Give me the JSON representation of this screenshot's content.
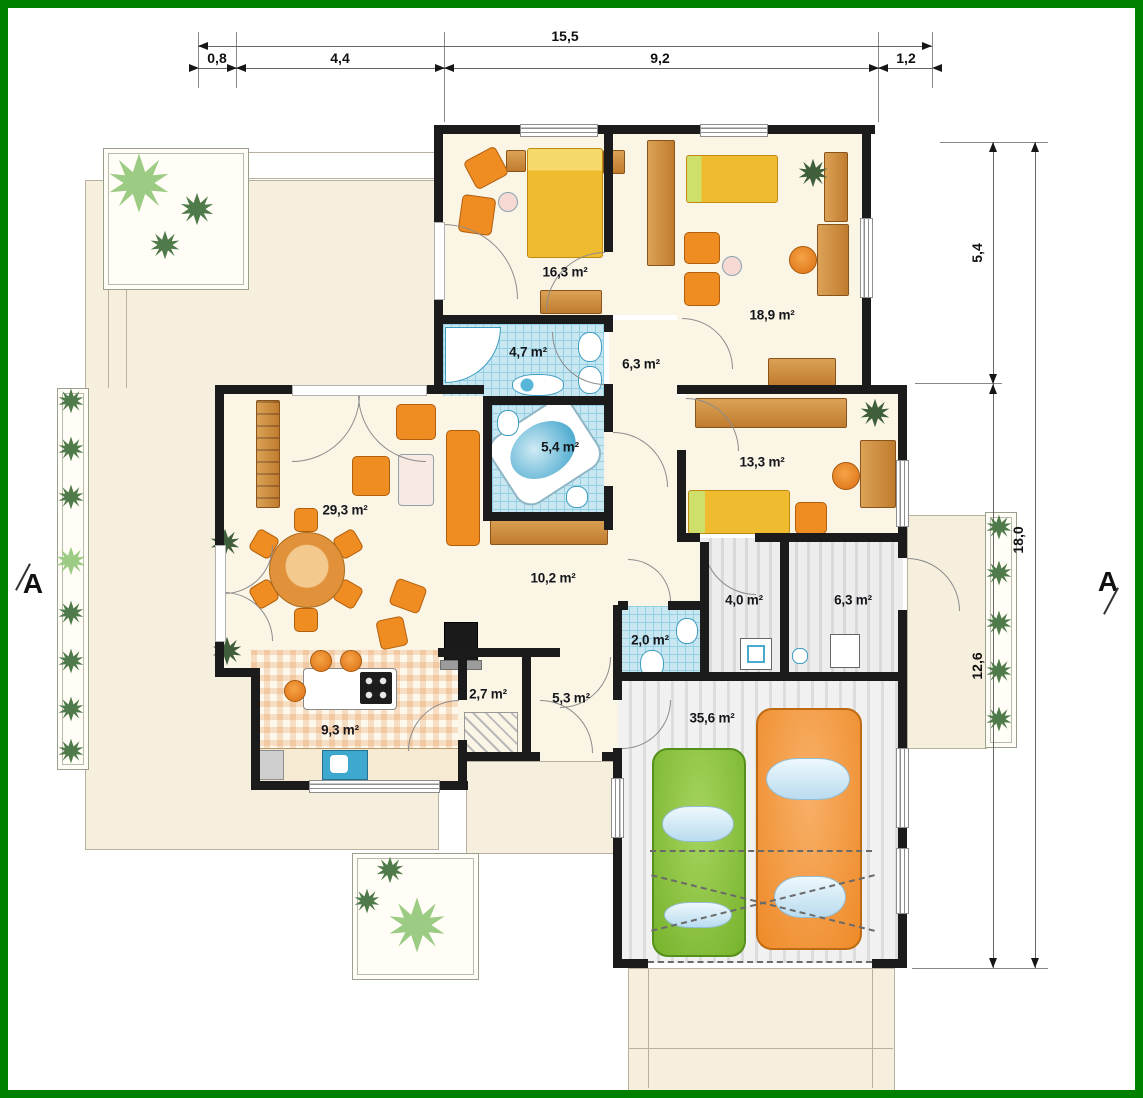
{
  "frame": {
    "color": "#008000"
  },
  "dimensions": {
    "top": {
      "total": "15,5",
      "segments": [
        "0,8",
        "4,4",
        "9,2",
        "1,2"
      ]
    },
    "right": {
      "total": "18,0",
      "segments": [
        "5,4",
        "12,6"
      ]
    }
  },
  "section_markers": {
    "left": "A",
    "right": "A"
  },
  "rooms": {
    "bedroom_1": {
      "area": "16,3 m²"
    },
    "bedroom_2": {
      "area": "18,9 m²"
    },
    "bathroom_1": {
      "area": "4,7 m²"
    },
    "hall_upper": {
      "area": "6,3 m²"
    },
    "bathroom_2": {
      "area": "5,4 m²"
    },
    "bedroom_3": {
      "area": "13,3 m²"
    },
    "living_room": {
      "area": "29,3 m²"
    },
    "hall_main": {
      "area": "10,2 m²"
    },
    "utility_laundry": {
      "area": "4,0 m²"
    },
    "utility_boiler": {
      "area": "6,3 m²"
    },
    "wc": {
      "area": "2,0 m²"
    },
    "pantry": {
      "area": "2,7 m²"
    },
    "hall_entry": {
      "area": "5,3 m²"
    },
    "kitchen": {
      "area": "9,3 m²"
    },
    "garage": {
      "area": "35,6 m²"
    }
  },
  "colors": {
    "frame_green": "#008000",
    "wall": "#1b1b1b",
    "terrace": "#f6efdd",
    "room_floor": "#fbf5e6",
    "bathroom_floor": "#c9e7f1",
    "garage_floor": "#e5e5e5",
    "bed_yellow": "#f0bc2f",
    "furniture_orange": "#ef8c22",
    "wood": "#c98440",
    "car_green": "#8dc63f",
    "car_orange": "#f49b3c",
    "plant_dark": "#4f7a49",
    "plant_light": "#9ccb84"
  }
}
